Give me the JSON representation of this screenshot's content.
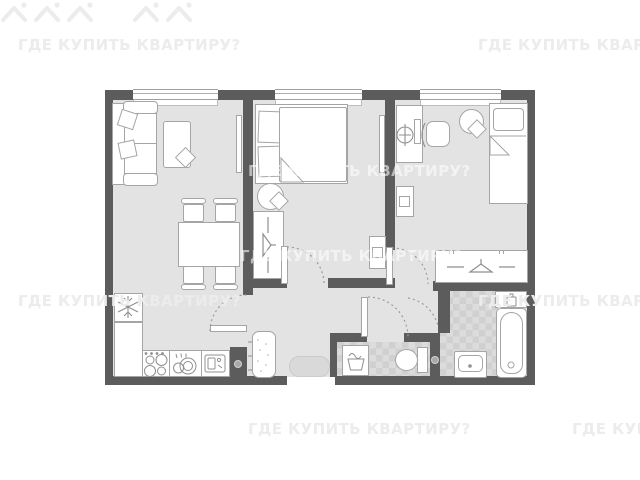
{
  "watermark": {
    "text": "ГДЕ КУПИТЬ КВАРТИРУ?",
    "icon": "house-icon"
  },
  "colors": {
    "background": "#ffffff",
    "wall": "#5c5c5c",
    "floor": "#e3e3e4",
    "furniture_outline": "#a5a5a5",
    "tile_light": "#dcdcdd",
    "tile_dark": "#d0d0d1",
    "watermark_on_white": "#ececec",
    "watermark_on_floor": "rgba(255,255,255,0.58)"
  },
  "floor_plan": {
    "type": "apartment-2-bedroom-floor-plan",
    "windows": 3,
    "door_swings": 5,
    "entry": "bottom-center",
    "rooms": [
      {
        "name": "living-room-kitchen",
        "furniture": [
          "sofa",
          "coffee-table",
          "side-table",
          "tv",
          "dining-table",
          "four-chairs",
          "refrigerator",
          "counter",
          "stove",
          "kitchen-sink",
          "washing-machine"
        ]
      },
      {
        "name": "bedroom-master",
        "furniture": [
          "double-bed",
          "tv",
          "pouf",
          "wardrobe",
          "dresser"
        ]
      },
      {
        "name": "bedroom-second",
        "furniture": [
          "desk",
          "desk-lamp",
          "desk-chair",
          "round-table",
          "single-bed",
          "dresser",
          "wardrobe"
        ]
      },
      {
        "name": "hallway",
        "furniture": [
          "radiator",
          "doormat"
        ]
      },
      {
        "name": "wc",
        "furniture": [
          "laundry-basket",
          "toilet"
        ]
      },
      {
        "name": "bathroom",
        "furniture": [
          "shelf",
          "bathtub",
          "sink"
        ]
      }
    ]
  }
}
